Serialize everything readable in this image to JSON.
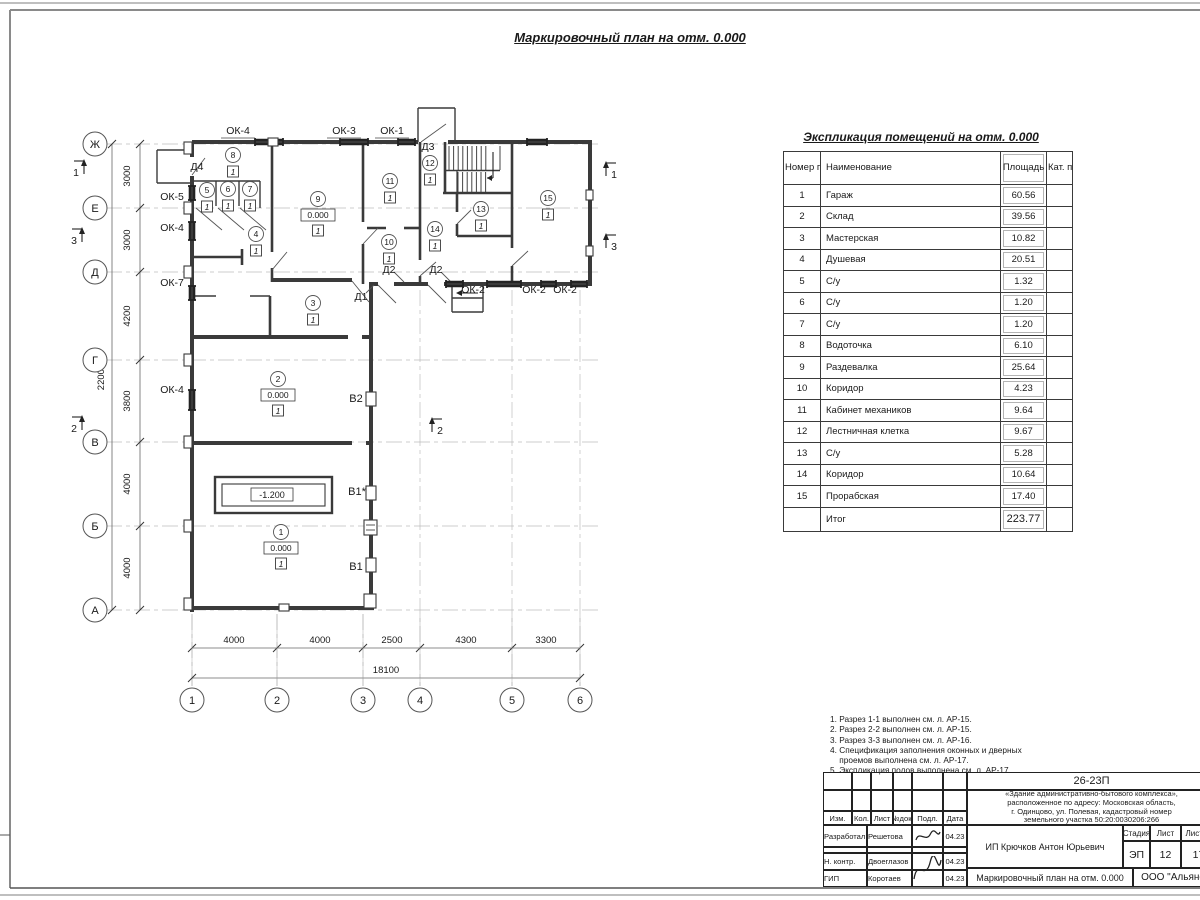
{
  "page": {
    "plan_title": "Маркировочный план на отм. 0.000"
  },
  "exp_table": {
    "title": "Экспликация помещений на отм. 0.000",
    "headers": {
      "num": "Номер помещ.",
      "name": "Наименование",
      "area": "Площадь",
      "cat": "Кат. пом."
    },
    "rows": [
      {
        "num": "1",
        "name": "Гараж",
        "area": "60.56"
      },
      {
        "num": "2",
        "name": "Склад",
        "area": "39.56"
      },
      {
        "num": "3",
        "name": "Мастерская",
        "area": "10.82"
      },
      {
        "num": "4",
        "name": "Душевая",
        "area": "20.51"
      },
      {
        "num": "5",
        "name": "С/у",
        "area": "1.32"
      },
      {
        "num": "6",
        "name": "С/у",
        "area": "1.20"
      },
      {
        "num": "7",
        "name": "С/у",
        "area": "1.20"
      },
      {
        "num": "8",
        "name": "Водоточка",
        "area": "6.10"
      },
      {
        "num": "9",
        "name": "Раздевалка",
        "area": "25.64"
      },
      {
        "num": "10",
        "name": "Коридор",
        "area": "4.23"
      },
      {
        "num": "11",
        "name": "Кабинет механиков",
        "area": "9.64"
      },
      {
        "num": "12",
        "name": "Лестничная клетка",
        "area": "9.67"
      },
      {
        "num": "13",
        "name": "С/у",
        "area": "5.28"
      },
      {
        "num": "14",
        "name": "Коридор",
        "area": "10.64"
      },
      {
        "num": "15",
        "name": "Прорабская",
        "area": "17.40"
      }
    ],
    "total_label": "Итог",
    "total_area": "223.77"
  },
  "notes": [
    "1. Разрез 1-1 выполнен см. л. АР-15.",
    "2. Разрез 2-2 выполнен см. л. АР-15.",
    "3. Разрез 3-3 выполнен см. л. АР-16.",
    "4. Спецификация заполнения оконных и дверных",
    "    проемов выполнена см. л. АР-17.",
    "5. Экспликация полов выполнена см. л. АР-17."
  ],
  "stamp": {
    "doc_code": "26-23П",
    "description": [
      "«Здание административно-бытового комплекса»,",
      "расположенное по адресу: Московская область,",
      "г. Одинцово, ул. Полевая, кадастровый номер",
      "земельного участка 50:20:0030206:266"
    ],
    "header_cols": [
      "Изм.",
      "Кол.",
      "Лист",
      "№док.",
      "Подл.",
      "Дата"
    ],
    "people": [
      {
        "role": "Разработал",
        "name": "Решетова",
        "date": "04.23"
      },
      {
        "role": "Н. контр.",
        "name": "Двоеглазов",
        "date": "04.23"
      },
      {
        "role": "ГИП",
        "name": "Коротаев",
        "date": "04.23"
      }
    ],
    "client": "ИП Крючков Антон Юрьевич",
    "sheet_title": "Маркировочный план на отм. 0.000",
    "org": "ООО \"Альянс\"",
    "stage_label": "Стадия",
    "sheet_label": "Лист",
    "sheets_label": "Листов",
    "stage": "ЭП",
    "sheet_no": "12",
    "sheets_total": "17"
  },
  "plan": {
    "axis_rows": [
      {
        "n": "Ж",
        "y": 144
      },
      {
        "n": "Е",
        "y": 208
      },
      {
        "n": "Д",
        "y": 272
      },
      {
        "n": "Г",
        "y": 360
      },
      {
        "n": "В",
        "y": 442
      },
      {
        "n": "Б",
        "y": 526
      },
      {
        "n": "А",
        "y": 610
      }
    ],
    "axis_cols": [
      {
        "n": "1",
        "x": 192
      },
      {
        "n": "2",
        "x": 277
      },
      {
        "n": "3",
        "x": 363
      },
      {
        "n": "4",
        "x": 420
      },
      {
        "n": "5",
        "x": 512
      },
      {
        "n": "6",
        "x": 580
      }
    ],
    "v_dims": [
      {
        "t": "3000",
        "y": 176
      },
      {
        "t": "3000",
        "y": 240
      },
      {
        "t": "4200",
        "y": 316
      },
      {
        "t": "3800",
        "y": 401
      },
      {
        "t": "4000",
        "y": 484
      },
      {
        "t": "4000",
        "y": 568
      }
    ],
    "v_total": {
      "t": "22000",
      "x": 104,
      "y": 377
    },
    "h_dims": [
      {
        "t": "4000",
        "x": 234
      },
      {
        "t": "4000",
        "x": 320
      },
      {
        "t": "2500",
        "x": 392
      },
      {
        "t": "4300",
        "x": 466
      },
      {
        "t": "3300",
        "x": 546
      }
    ],
    "h_total": {
      "t": "18100",
      "x": 386,
      "y": 673
    },
    "window_labels": [
      {
        "t": "ОК-4",
        "x": 238,
        "y": 131,
        "u": 1
      },
      {
        "t": "ОК-3",
        "x": 344,
        "y": 131,
        "u": 1
      },
      {
        "t": "ОК-1",
        "x": 392,
        "y": 131,
        "u": 1
      },
      {
        "t": "ОК-5",
        "x": 172,
        "y": 197
      },
      {
        "t": "ОК-4",
        "x": 172,
        "y": 228
      },
      {
        "t": "ОК-7",
        "x": 172,
        "y": 283
      },
      {
        "t": "ОК-4",
        "x": 172,
        "y": 390
      },
      {
        "t": "ОК-2",
        "x": 473,
        "y": 290
      },
      {
        "t": "ОК-2",
        "x": 534,
        "y": 290
      },
      {
        "t": "ОК-2",
        "x": 565,
        "y": 290
      }
    ],
    "door_labels": [
      {
        "t": "Д4",
        "x": 197,
        "y": 167
      },
      {
        "t": "Д3",
        "x": 428,
        "y": 147
      },
      {
        "t": "Д2",
        "x": 389,
        "y": 270
      },
      {
        "t": "Д2",
        "x": 436,
        "y": 270
      },
      {
        "t": "Д1",
        "x": 361,
        "y": 297
      }
    ],
    "rooms": [
      {
        "n": "8",
        "x": 233,
        "y": 155
      },
      {
        "n": "5",
        "x": 207,
        "y": 190
      },
      {
        "n": "6",
        "x": 228,
        "y": 189
      },
      {
        "n": "7",
        "x": 250,
        "y": 189
      },
      {
        "n": "9",
        "x": 318,
        "y": 199,
        "level": "0.000"
      },
      {
        "n": "4",
        "x": 256,
        "y": 234
      },
      {
        "n": "11",
        "x": 390,
        "y": 181
      },
      {
        "n": "12",
        "x": 430,
        "y": 163
      },
      {
        "n": "13",
        "x": 481,
        "y": 209
      },
      {
        "n": "14",
        "x": 435,
        "y": 229
      },
      {
        "n": "10",
        "x": 389,
        "y": 242
      },
      {
        "n": "15",
        "x": 548,
        "y": 198
      },
      {
        "n": "3",
        "x": 313,
        "y": 303
      },
      {
        "n": "2",
        "x": 278,
        "y": 379,
        "level": "0.000"
      },
      {
        "n": "1",
        "x": 281,
        "y": 532,
        "level": "0.000"
      }
    ],
    "floor_mark": "1",
    "pit_label": {
      "t": "-1.200",
      "x": 272,
      "y": 495
    },
    "riser_labels": [
      {
        "t": "В2",
        "x": 356,
        "y": 398
      },
      {
        "t": "В1*",
        "x": 357,
        "y": 491
      },
      {
        "t": "В1",
        "x": 356,
        "y": 566
      }
    ],
    "section_marks": [
      {
        "n": "1",
        "x": 78,
        "y": 172,
        "side": "left"
      },
      {
        "n": "3",
        "x": 76,
        "y": 240,
        "side": "left"
      },
      {
        "n": "2",
        "x": 76,
        "y": 428,
        "side": "left"
      },
      {
        "n": "1",
        "x": 612,
        "y": 174,
        "side": "right"
      },
      {
        "n": "3",
        "x": 612,
        "y": 246,
        "side": "right"
      },
      {
        "n": "2",
        "x": 438,
        "y": 430,
        "side": "right"
      }
    ]
  }
}
